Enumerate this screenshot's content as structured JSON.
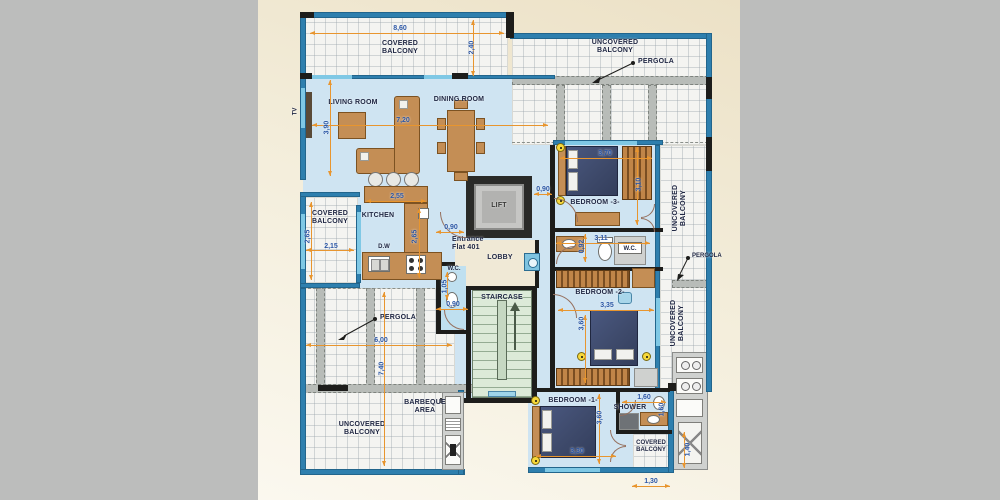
{
  "colors": {
    "outer-gray": "#bcbdbc",
    "paper": "#f2ecda",
    "interior": "#cfe4f2",
    "wall-blue": "#2e7fae",
    "wall-black": "#1d1d1b",
    "window-cyan": "#7fc8e5",
    "dim-text": "#2b56a5",
    "dim-line": "#e8952e",
    "wood": "#c48e55",
    "stair-green": "#dcead8",
    "bed-navy": "#3e4a6b",
    "pergola-gray": "#b8bcb8",
    "label-dark": "#212844"
  },
  "labels": {
    "covered_balcony_top": "COVERED BALCONY",
    "uncovered_balcony_top": "UNCOVERED BALCONY",
    "pergola_top": "PERGOLA",
    "living_room": "LIVING ROOM",
    "dining_room": "DINING ROOM",
    "tv": "TV",
    "kitchen": "KITCHEN",
    "dw": "D.W",
    "lift": "LIFT",
    "entrance": "Entrance Flat 401",
    "lobby": "LOBBY",
    "bedroom3": "BEDROOM -3-",
    "wc_bedroom3": "W.C.",
    "uncovered_balcony_right_upper": "UNCOVERED BALCONY",
    "pergola_right": "PERGOLA",
    "bedroom2": "BEDROOM -2-",
    "uncovered_balcony_right_lower": "UNCOVERED BALCONY",
    "wc_small": "W.C.",
    "staircase": "STAIRCASE",
    "pergola_left": "PERGOLA",
    "uncovered_balcony_bottom": "UNCOVERED BALCONY",
    "barbeque": "BARBEQUE AREA",
    "bedroom1": "BEDROOM -1-",
    "shower": "SHOWER",
    "covered_balcony_bottom": "COVERED BALCONY"
  },
  "dims": {
    "d860": "8,60",
    "d240": "2,40",
    "d390": "3,90",
    "d720": "7,20",
    "d255": "2,55",
    "d265_kitchen": "2,65",
    "d265_balcony": "2,65",
    "d215": "2,15",
    "d090_entry": "0,90",
    "d090_lift": "0,90",
    "d370": "3,70",
    "d310": "3,10",
    "d311": "3,11",
    "d092": "0,92",
    "d335": "3,35",
    "d360_bed2": "3,60",
    "d105": "1,05",
    "d090_wc": "0,90",
    "d600": "6,00",
    "d740": "7,40",
    "d330": "3,30",
    "d360_bed1": "3,60",
    "d160_shower_h": "1,60",
    "d160_shower_v": "1,60",
    "d140": "1,40",
    "d130": "1,30"
  }
}
